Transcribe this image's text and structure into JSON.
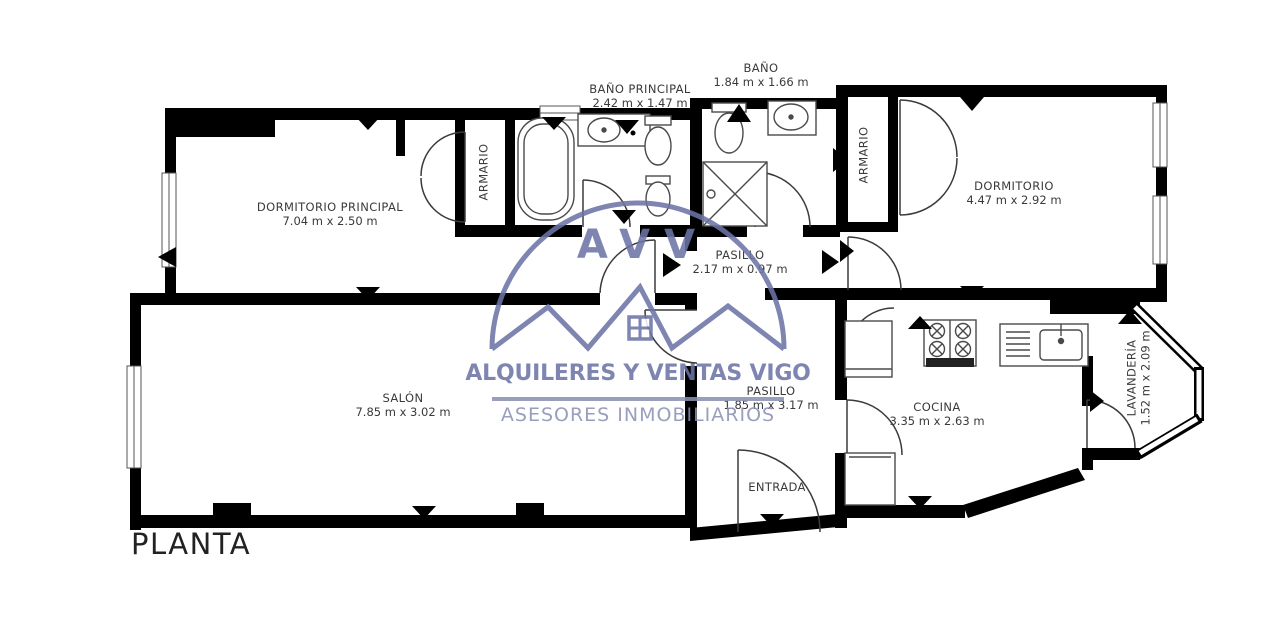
{
  "title": "PLANTA",
  "watermark": {
    "initials": "AVV",
    "line1": "ALQUILERES Y VENTAS VIGO",
    "line2": "ASESORES INMOBILIARIOS",
    "color": "#6b74a6",
    "light_color": "#8a90b5"
  },
  "rooms": {
    "dormitorio_principal": {
      "name": "DORMITORIO PRINCIPAL",
      "dims": "7.04 m x 2.50 m"
    },
    "bano_principal": {
      "name": "BAÑO PRINCIPAL",
      "dims": "2.42 m x 1.47 m"
    },
    "bano": {
      "name": "BAÑO",
      "dims": "1.84 m x 1.66 m"
    },
    "armario_1": {
      "name": "ARMARIO"
    },
    "armario_2": {
      "name": "ARMARIO"
    },
    "dormitorio": {
      "name": "DORMITORIO",
      "dims": "4.47 m x 2.92 m"
    },
    "pasillo_1": {
      "name": "PASILLO",
      "dims": "2.17 m x 0.97 m"
    },
    "salon": {
      "name": "SALÓN",
      "dims": "7.85 m x 3.02 m"
    },
    "pasillo_2": {
      "name": "PASILLO",
      "dims": "1.85 m x 3.17 m"
    },
    "cocina": {
      "name": "COCINA",
      "dims": "3.35 m x 2.63 m"
    },
    "lavanderia": {
      "name": "LAVANDERÍA",
      "dims": "1.52 m x 2.09 m"
    },
    "entrada": {
      "name": "ENTRADA"
    }
  },
  "colors": {
    "wall": "#000000",
    "fixture_line": "#4a4a4a",
    "label_text": "#3a3a3a"
  }
}
